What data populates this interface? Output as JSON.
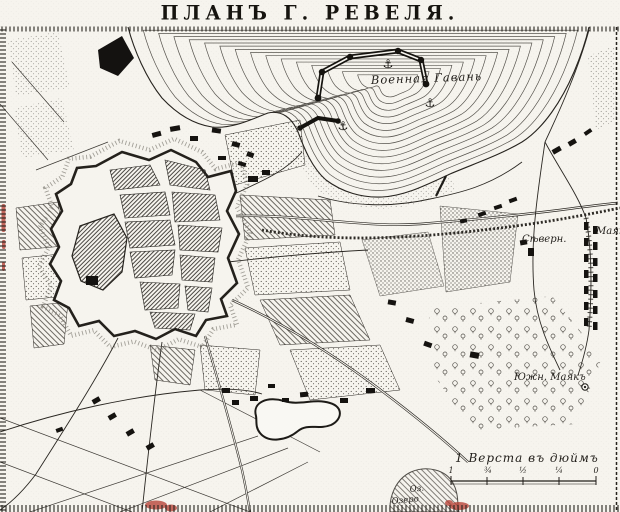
{
  "title": "ПЛАНЪ Г. РЕВЕЛЯ.",
  "map_labels": {
    "military_harbor": "Военная Гавань",
    "north_lighthouse_word1": "Сѣверн.",
    "north_lighthouse_word2": "Маякъ",
    "south_lighthouse": "Южн. Маякъ",
    "lake_abbreviation": "Оз.",
    "lake_name_partial": "Озеро"
  },
  "scale_bar": {
    "caption": "1 Верста въ дюймъ",
    "ticks": [
      "1",
      "¾",
      "½",
      "¼",
      "0"
    ]
  },
  "icons": {
    "anchor": "⚓"
  },
  "colors": {
    "paper": "#f6f4ee",
    "ink": "#1c1a17",
    "water_line": "#57544e",
    "red_stamp": "#b43a2e"
  }
}
